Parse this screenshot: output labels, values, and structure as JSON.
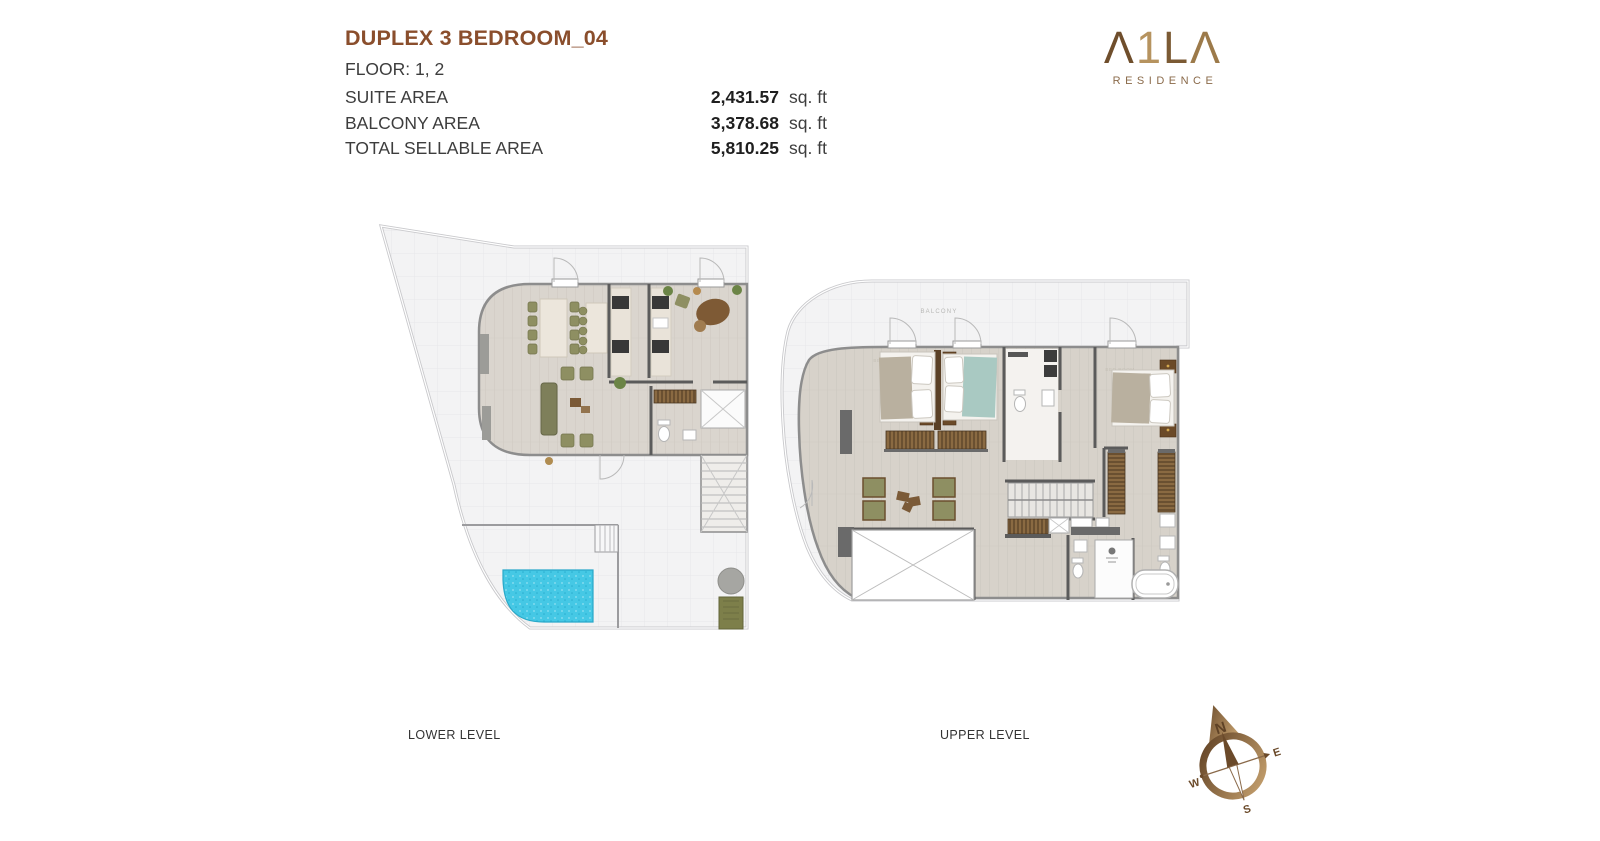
{
  "header": {
    "title": "DUPLEX 3 BEDROOM_04",
    "floor_label": "FLOOR: 1, 2",
    "areas": [
      {
        "label": "SUITE AREA",
        "value": "2,431.57",
        "unit": "sq. ft"
      },
      {
        "label": "BALCONY AREA",
        "value": "3,378.68",
        "unit": "sq. ft"
      },
      {
        "label": "TOTAL SELLABLE AREA",
        "value": "5,810.25",
        "unit": "sq. ft"
      }
    ]
  },
  "logo": {
    "name": "A1LA",
    "display_letters": [
      "Λ",
      "1",
      "L",
      "Λ"
    ],
    "subtitle": "RESIDENCE"
  },
  "plans": {
    "lower": {
      "caption": "LOWER LEVEL"
    },
    "upper": {
      "caption": "UPPER LEVEL",
      "balcony_label": "BALCONY",
      "bedroom_label": "BED ROOM"
    }
  },
  "compass": {
    "north": "N",
    "east": "E",
    "west": "W",
    "south": "S"
  },
  "colors": {
    "title_brown": "#8a4e2c",
    "logo_bronze_dark": "#6f4e2c",
    "logo_bronze_light": "#c9a471",
    "text_dark": "#3d3d3d",
    "pool_blue": "#45c8e5",
    "terrace_gray": "#f3f3f4",
    "floor_wood": "#d9d4cc",
    "wall_dark": "#5b5b5b",
    "furniture_olive": "#8e8f62",
    "furniture_brown": "#7a5a35",
    "bed_teal": "#a9c9c2",
    "bed_tan": "#b9b09f"
  }
}
